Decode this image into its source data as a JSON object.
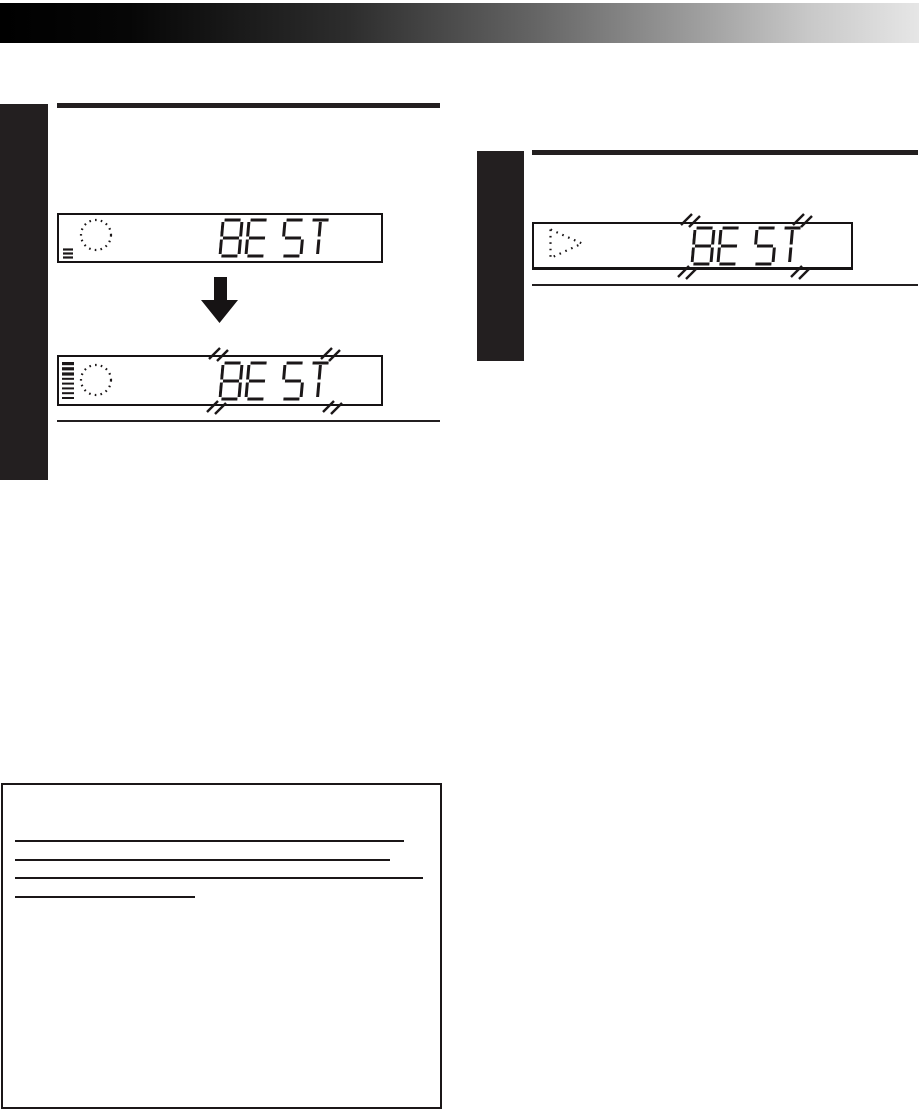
{
  "meta": {
    "ink_color": "#231f20",
    "paper_color": "#ffffff",
    "banner_gradient": [
      "#000000",
      "#e6e6e6"
    ]
  },
  "left_column": {
    "display_before": {
      "lcd_text": "BE ST",
      "blinking": false,
      "icons": [
        "record-standby-circle-icon",
        "cassette-loaded-icon"
      ]
    },
    "transition_arrow": "down",
    "display_after": {
      "lcd_text": "BE ST",
      "blinking": true,
      "icons": [
        "tape-remaining-bars-icon",
        "record-standby-circle-icon"
      ]
    }
  },
  "right_column": {
    "display": {
      "lcd_text": "BE ST",
      "blinking": true,
      "icons": [
        "play-triangle-icon"
      ]
    }
  },
  "note_box": {
    "underlines": [
      {
        "width": 389
      },
      {
        "width": 375
      },
      {
        "width": 408
      },
      {
        "width": 180
      }
    ]
  }
}
